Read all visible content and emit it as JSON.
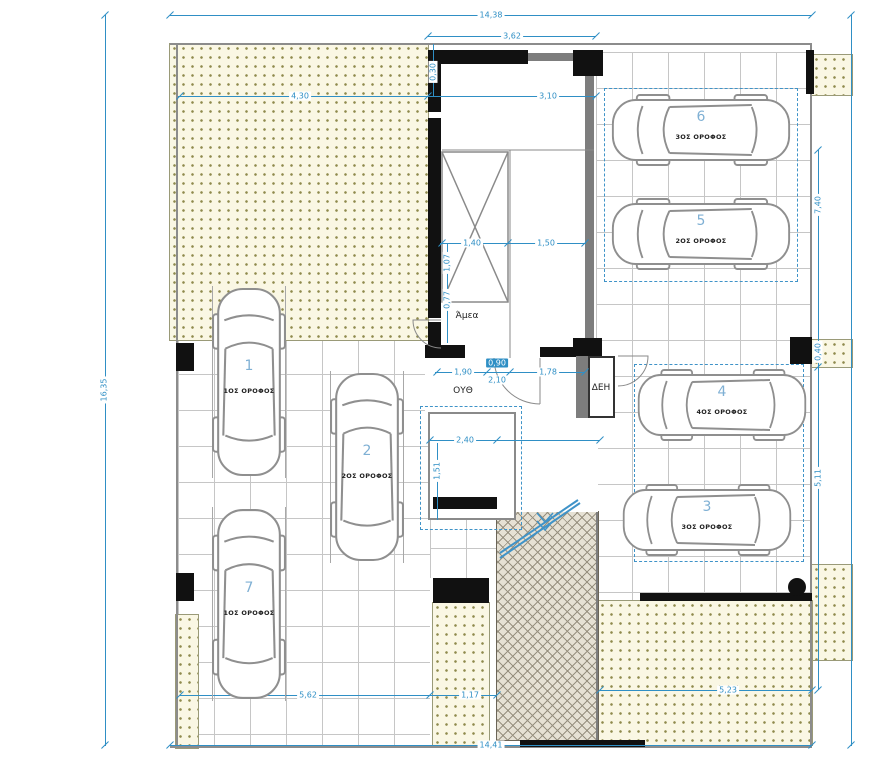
{
  "drawing": {
    "type": "Architectural ground-floor parking site plan",
    "colors": {
      "dimension_accent": "#2f8fc5",
      "stall_number": "#7fb0d4",
      "stipple_bg": "#faf7e4",
      "stipple_dot": "#8f8a4e",
      "ramp_bg": "#e6e1d4",
      "ramp_line": "#97907f",
      "wall": "#111111",
      "grid_line": "#c6c6c6"
    },
    "room_labels": [
      {
        "text": "Άμεα",
        "x": 467,
        "y": 316
      },
      {
        "text": "ΟΥΘ",
        "x": 463,
        "y": 391
      },
      {
        "text": "ΔΕΗ",
        "x": 601,
        "y": 388
      }
    ],
    "dimensions": [
      {
        "text": "14,38",
        "x": 491,
        "y": 15
      },
      {
        "text": "3,62",
        "x": 512,
        "y": 36
      },
      {
        "text": "4,30",
        "x": 300,
        "y": 96
      },
      {
        "text": "3,10",
        "x": 548,
        "y": 96
      },
      {
        "text": "0,30",
        "x": 433,
        "y": 72,
        "rot": true
      },
      {
        "text": "1,40",
        "x": 472,
        "y": 243
      },
      {
        "text": "1,50",
        "x": 546,
        "y": 243
      },
      {
        "text": "1,07",
        "x": 447,
        "y": 263,
        "rot": true
      },
      {
        "text": "0,77",
        "x": 447,
        "y": 300,
        "rot": true
      },
      {
        "text": "1,90",
        "x": 463,
        "y": 372
      },
      {
        "text": "0,90",
        "x": 497,
        "y": 363,
        "hl": true
      },
      {
        "text": "2,10",
        "x": 497,
        "y": 380
      },
      {
        "text": "1,78",
        "x": 548,
        "y": 372
      },
      {
        "text": "2,40",
        "x": 465,
        "y": 440
      },
      {
        "text": "1,51",
        "x": 437,
        "y": 471,
        "rot": true
      },
      {
        "text": "16,35",
        "x": 104,
        "y": 390,
        "rot": true
      },
      {
        "text": "7,40",
        "x": 818,
        "y": 205,
        "rot": true
      },
      {
        "text": "0,40",
        "x": 818,
        "y": 352,
        "rot": true
      },
      {
        "text": "5,11",
        "x": 818,
        "y": 478,
        "rot": true
      },
      {
        "text": "5,62",
        "x": 308,
        "y": 695
      },
      {
        "text": "1,17",
        "x": 470,
        "y": 695
      },
      {
        "text": "5,23",
        "x": 728,
        "y": 690
      },
      {
        "text": "14,41",
        "x": 491,
        "y": 745
      }
    ],
    "stalls": [
      {
        "number": "1",
        "floor": "1ΟΣ ΟΡΟΦΟΣ",
        "x": 212,
        "y": 286,
        "w": 74,
        "h": 192,
        "dir": "v"
      },
      {
        "number": "2",
        "floor": "2ΟΣ ΟΡΟΦΟΣ",
        "x": 330,
        "y": 371,
        "w": 74,
        "h": 192,
        "dir": "v"
      },
      {
        "number": "7",
        "floor": "1ΟΣ ΟΡΟΦΟΣ",
        "x": 212,
        "y": 507,
        "w": 74,
        "h": 194,
        "dir": "v"
      },
      {
        "number": "6",
        "floor": "3ΟΣ ΟΡΟΦΟΣ",
        "x": 610,
        "y": 94,
        "w": 182,
        "h": 72,
        "dir": "h"
      },
      {
        "number": "5",
        "floor": "2ΟΣ ΟΡΟΦΟΣ",
        "x": 610,
        "y": 198,
        "w": 182,
        "h": 72,
        "dir": "h"
      },
      {
        "number": "4",
        "floor": "4ΟΣ ΟΡΟΦΟΣ",
        "x": 636,
        "y": 369,
        "w": 172,
        "h": 72,
        "dir": "h"
      },
      {
        "number": "3",
        "floor": "3ΟΣ ΟΡΟΦΟΣ",
        "x": 621,
        "y": 484,
        "w": 172,
        "h": 72,
        "dir": "h"
      }
    ]
  }
}
